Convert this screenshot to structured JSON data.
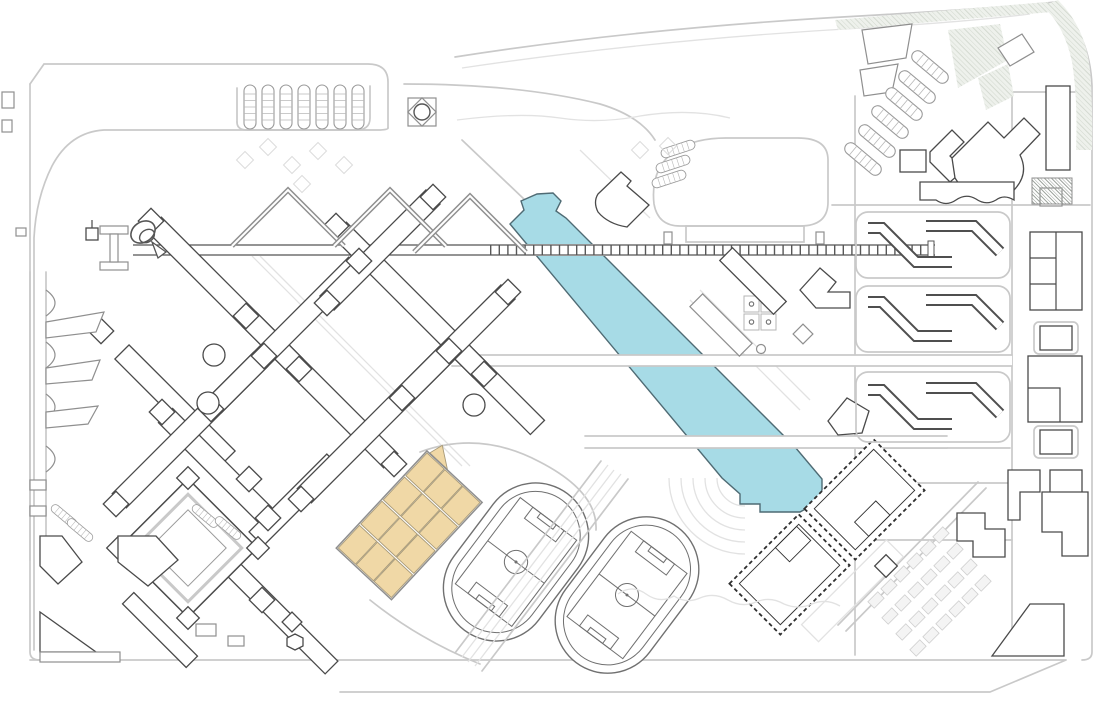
{
  "title": "campus-master-plan-drawing",
  "canvas": {
    "width": 1096,
    "height": 705,
    "background": "#ffffff"
  },
  "palette": {
    "background": "#ffffff",
    "road_gray": "#c9c9c9",
    "road_faint": "#e2e2e2",
    "outline_dark": "#4a4a4a",
    "outline_darkest": "#2f2f2f",
    "outline_mid": "#8f8f8f",
    "outline_soft": "#9a9a9a",
    "track_gray": "#707070",
    "water_fill": "#a7dbe6",
    "water_edge": "#4f6b74",
    "sand_fill": "#f0d8a6",
    "sand_edge": "#a89a78",
    "hatch_green_tint": "#ccd3c8",
    "hatch_bg": "#eef1ec",
    "garden_fill": "#f4f4f4"
  },
  "features": [
    {
      "id": "water-canal",
      "kind": "water",
      "note": "diagonal canal in three segments crossed by two roads and a foot bridge",
      "color": "#a7dbe6"
    },
    {
      "id": "axis-bridge",
      "kind": "promenade",
      "note": "long east-west pedestrian axis with ladder rungs"
    },
    {
      "id": "academic-lattice",
      "kind": "buildings",
      "note": "diagonal 45-degree lattice of linked teaching buildings with square nodes",
      "bars": 12,
      "nodes": 20,
      "round_halls": 3
    },
    {
      "id": "chevron-buildings",
      "kind": "buildings",
      "count": 3,
      "note": "V-shaped double-outline roofs at top of lattice"
    },
    {
      "id": "highlighted-blocks",
      "kind": "development-site",
      "color": "#f0d8a6",
      "cells": 12,
      "note": "tan tilted grid of blocks"
    },
    {
      "id": "athletics-tracks",
      "kind": "sports",
      "count": 2,
      "note": "running tracks with full soccer-field markings, tilted"
    },
    {
      "id": "amphitheater-terraces",
      "kind": "landscape",
      "arcs": 5
    },
    {
      "id": "basketball-courts",
      "kind": "sports",
      "count": 4
    },
    {
      "id": "planned-buildings-dashed",
      "kind": "buildings",
      "count": 2,
      "note": "dashed-outline twin rectangles near canal end"
    },
    {
      "id": "dormitory-rows",
      "kind": "buildings",
      "rows": 3,
      "note": "bent Z-shaped bars inside rounded road frames"
    },
    {
      "id": "right-column-buildings",
      "kind": "buildings",
      "note": "E-shaped and framed square buildings along east edge"
    },
    {
      "id": "nw-parking",
      "kind": "parking",
      "stall_rows": 7
    },
    {
      "id": "ne-parking",
      "kind": "parking",
      "stall_rows": 6
    },
    {
      "id": "plaza-small-stalls",
      "kind": "parking",
      "stall_rows": 3
    },
    {
      "id": "pavilion-marker",
      "kind": "icon",
      "note": "square pavilion with inscribed diamond and circle"
    },
    {
      "id": "spiral-landmark",
      "kind": "icon",
      "note": "snail-spiral sculpture at west end of axis"
    },
    {
      "id": "i-beam-terminus",
      "kind": "structure"
    },
    {
      "id": "north-plaza-loop",
      "kind": "road",
      "note": "large rounded plaza loop"
    },
    {
      "id": "fan-building",
      "kind": "building",
      "note": "auditorium with fan-shaped edge"
    },
    {
      "id": "scalloped-building",
      "kind": "building",
      "note": "building with wavy scalloped south edge"
    },
    {
      "id": "courtyard-building",
      "kind": "building",
      "note": "nested rotated squares with corner node pavilions"
    },
    {
      "id": "waterfront-piers",
      "kind": "landscape",
      "note": "west edge with semicircular bastions and angled wings"
    },
    {
      "id": "garden-plots",
      "kind": "landscape",
      "note": "light diagonal grid of allotment plots, south-east"
    },
    {
      "id": "corner-hatch-green",
      "kind": "landscape",
      "color": "#ccd3c8",
      "note": "hatched green band along north-east corner"
    },
    {
      "id": "perimeter-roads",
      "kind": "road",
      "color": "#c9c9c9"
    }
  ]
}
